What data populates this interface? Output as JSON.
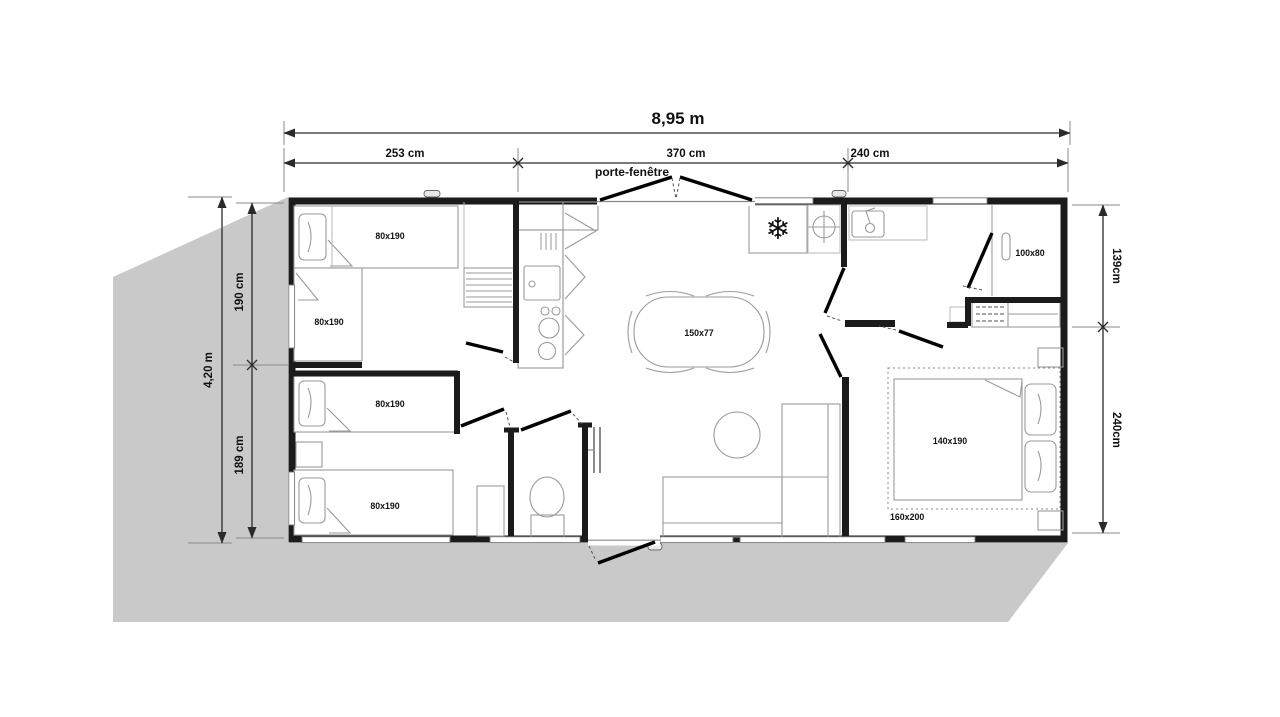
{
  "plan": {
    "dims": {
      "total_width": "8,95 m",
      "width_segments": [
        "253 cm",
        "370 cm",
        "240 cm"
      ],
      "total_depth": "4,20 m",
      "left_segments": [
        "190 cm",
        "189 cm"
      ],
      "right_segments": [
        "139cm",
        "240cm"
      ]
    },
    "openings": {
      "patio_door": "porte-fenêtre"
    },
    "furniture": {
      "single_beds": [
        "80x190",
        "80x190",
        "80x190",
        "80x190"
      ],
      "dining_table": "150x77",
      "shower": "100x80",
      "double_bed": "140x190",
      "bed_footprint": "160x200"
    },
    "icons": {
      "snowflake": "❄"
    },
    "colors": {
      "shadow": "#c9c9c9",
      "walls": "#1b1b1b",
      "furniture_stroke": "#9a9a9a",
      "background": "#ffffff"
    }
  }
}
